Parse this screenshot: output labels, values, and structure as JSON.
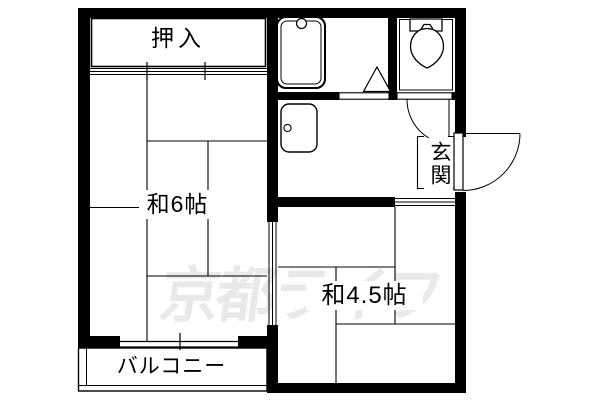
{
  "floorplan": {
    "watermark_text": "京都ライフ",
    "labels": {
      "closet": "押入",
      "room6": "和6帖",
      "room45": "和4.5帖",
      "genkan": "玄関",
      "balcony": "バルコニー"
    },
    "colors": {
      "line": "#000000",
      "background": "#ffffff",
      "watermark": "#e9e9e9"
    },
    "fixtures": [
      {
        "icon": "bathtub-icon"
      },
      {
        "icon": "toilet-icon"
      },
      {
        "icon": "kitchen-sink-icon"
      }
    ],
    "doors": [
      {
        "icon": "entrance-door-swing-arc"
      },
      {
        "icon": "toilet-door-swing-arc"
      },
      {
        "icon": "bathroom-door-triangle-icon"
      },
      {
        "icon": "sliding-door-tracks"
      },
      {
        "icon": "window-glass-lines"
      }
    ]
  }
}
